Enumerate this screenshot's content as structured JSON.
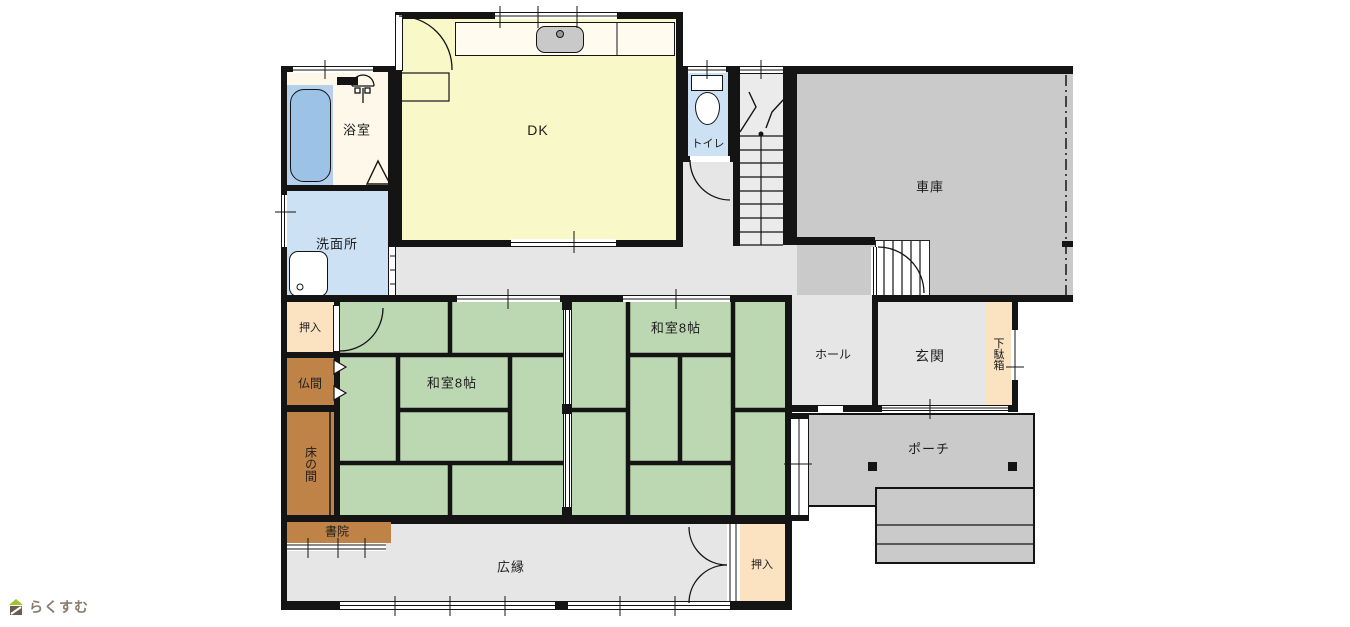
{
  "rooms": {
    "dk": {
      "label": "DK"
    },
    "bathroom": {
      "label": "浴室"
    },
    "washroom": {
      "label": "洗面所"
    },
    "toilet": {
      "label": "トイレ"
    },
    "garage": {
      "label": "車庫"
    },
    "washitsu_left": {
      "label": "和室8帖"
    },
    "washitsu_right": {
      "label": "和室8帖"
    },
    "hall": {
      "label": "ホール"
    },
    "genkan": {
      "label": "玄関"
    },
    "getabako": {
      "label": "下駄箱"
    },
    "porch": {
      "label": "ポーチ"
    },
    "oshiire_top": {
      "label": "押入"
    },
    "butsuma": {
      "label": "仏間"
    },
    "tokonoma": {
      "label": "床の間"
    },
    "shoin": {
      "label": "書院"
    },
    "hiroen": {
      "label": "広縁"
    },
    "oshiire_bottom": {
      "label": "押入"
    }
  },
  "logo": {
    "text": "らくすむ"
  },
  "icons": [
    "bathtub",
    "shower-icon",
    "wash-basin",
    "toilet-bowl",
    "kitchen-sink",
    "staircase",
    "garage-steps",
    "porch-steps",
    "porch-pillar",
    "door-arc",
    "sliding-door",
    "house-icon"
  ],
  "colors": {
    "wall": "#141414",
    "dk_floor": "#f8f8c8",
    "tatami_green": "#bcd8b2",
    "wet_area_blue": "#cde1f5",
    "bathtub_blue": "#9cc2e6",
    "closet_peach": "#fbe2c0",
    "wood_brown": "#bf8348",
    "garage_gray": "#cacaca",
    "corridor_gray": "#e6e6e6",
    "bath_floor_cream": "#fdf8ea",
    "logo_roof_green": "#9fc22e",
    "logo_body_brown": "#6f5b4e"
  }
}
